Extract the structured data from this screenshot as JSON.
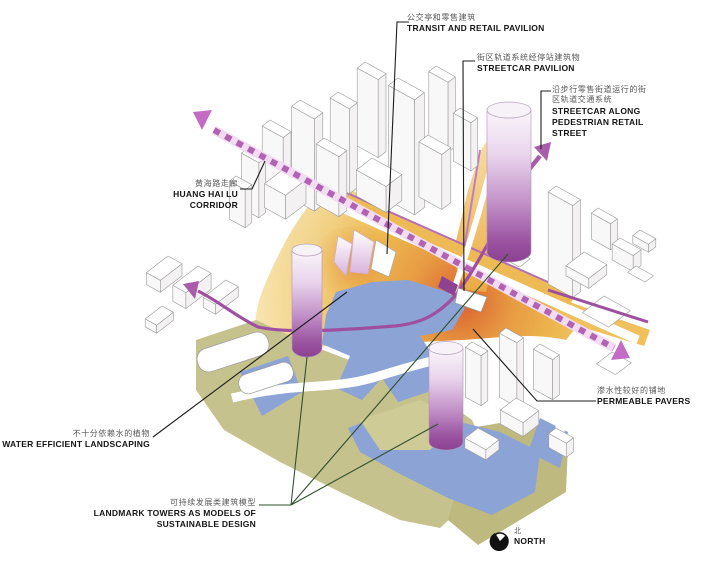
{
  "title": "Sustainable design site diagram (axonometric urban block plan)",
  "labels": {
    "transit_retail": {
      "zh": "公交亭和零售建筑",
      "en": "TRANSIT AND RETAIL PAVILION"
    },
    "streetcar_pavilion": {
      "zh": "街区轨道系统经停站建筑物",
      "en": "STREETCAR PAVILION"
    },
    "streetcar_street": {
      "zh": "沿步行零售街道运行的街区轨道交通系统",
      "en": "STREETCAR ALONG PEDESTRIAN RETAIL STREET"
    },
    "huang_hai": {
      "zh": "黄海路走廊",
      "en": "HUANG HAI LU CORRIDOR"
    },
    "permeable": {
      "zh": "渗水性较好的铺地",
      "en": "PERMEABLE PAVERS"
    },
    "water_efficient": {
      "zh": "不十分依赖水的植物",
      "en": "WATER EFFICIENT LANDSCAPING"
    },
    "landmark": {
      "zh": "可持续发展类建筑模型",
      "en": "LANDMARK TOWERS AS MODELS OF SUSTAINABLE DESIGN"
    },
    "north": {
      "zh": "北",
      "en": "NORTH"
    }
  },
  "icons": {
    "north_compass": "north-compass-icon",
    "corridor_arrows": "dashed-corridor-arrow-icons",
    "streetcar_arrows": "streetcar-direction-arrow-icons"
  },
  "colors": {
    "streetcar_purple": "#9F4F9F",
    "corridor_dash_purple": "#B262B2",
    "arrowhead_orchid": "#C36CC3",
    "ground_amber": "#EBAE4C",
    "ground_hot_orange": "#D96030",
    "permeable_blue": "#8CA3D6",
    "landscape_olive": "#C6C28D",
    "landmark_tower_purple": "#8C4192",
    "leader_black": "#1c1c1c",
    "leader_green": "#30502C",
    "building_outline_gray": "#9b9b9b"
  }
}
